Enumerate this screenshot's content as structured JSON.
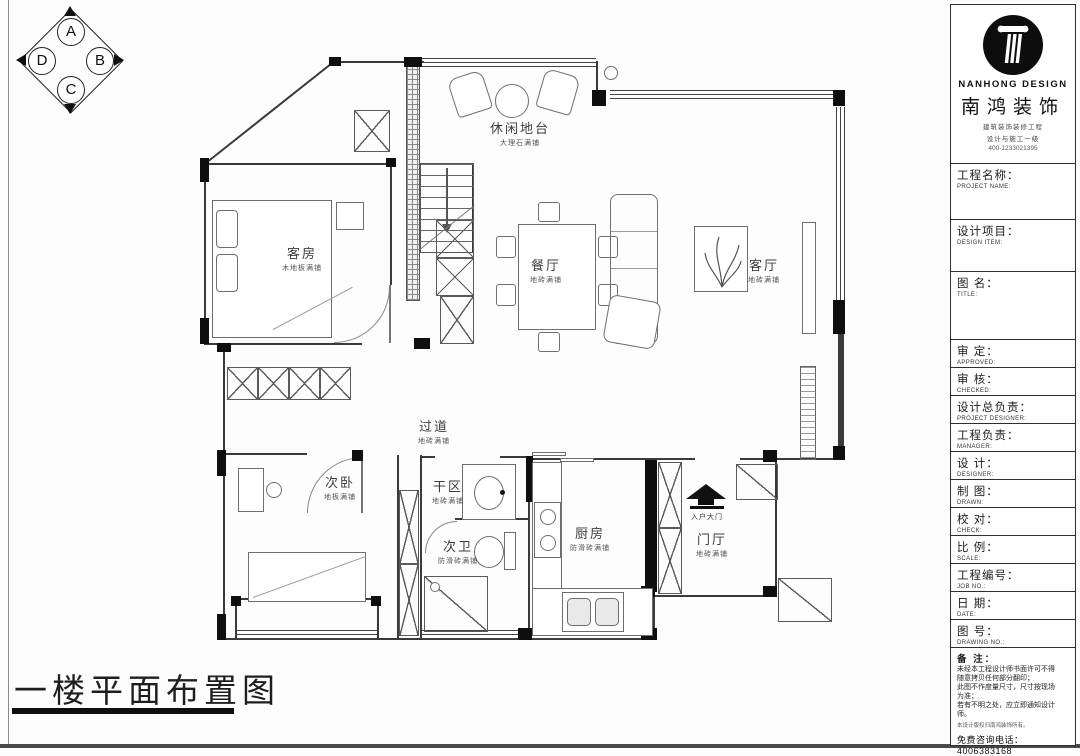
{
  "sheet": {
    "title": "一楼平面布置图",
    "accent_black": "#0d0d0d",
    "line_color": "#3a3a3a"
  },
  "compass": {
    "top": "A",
    "right": "B",
    "bottom": "C",
    "left": "D"
  },
  "plan": {
    "rooms": [
      {
        "name": "客房",
        "finish": "木地板满铺"
      },
      {
        "name": "休闲地台",
        "finish": "大理石满铺"
      },
      {
        "name": "餐厅",
        "finish": "地砖满铺"
      },
      {
        "name": "客厅",
        "finish": "地砖满铺"
      },
      {
        "name": "过道",
        "finish": "地砖满铺"
      },
      {
        "name": "次卧",
        "finish": "地板满铺"
      },
      {
        "name": "干区",
        "finish": "地砖满铺"
      },
      {
        "name": "次卫",
        "finish": "防滑砖满铺"
      },
      {
        "name": "厨房",
        "finish": "防滑砖满铺"
      },
      {
        "name": "门厅",
        "finish": "地砖满铺"
      }
    ],
    "entry_label": "入户大门"
  },
  "title_block": {
    "logo": {
      "en": "NANHONG DESIGN",
      "cn": "南鸿装饰",
      "sub1": "建筑装饰装修工程",
      "sub2": "设计与施工一级",
      "phone": "400-1233021395",
      "icon": "column-icon"
    },
    "fields": [
      {
        "cn": "工程名称：",
        "en": "PROJECT NAME:"
      },
      {
        "cn": "设计项目：",
        "en": "DESIGN ITEM:"
      },
      {
        "cn": "图  名：",
        "en": "TITLE:"
      },
      {
        "cn": "审  定：",
        "en": "APPROVED:"
      },
      {
        "cn": "审  核：",
        "en": "CHECKED:"
      },
      {
        "cn": "设计总负责：",
        "en": "PROJECT DESIGNER:"
      },
      {
        "cn": "工程负责：",
        "en": "MANAGER:"
      },
      {
        "cn": "设  计：",
        "en": "DESIGNER:"
      },
      {
        "cn": "制  图：",
        "en": "DRAWN:"
      },
      {
        "cn": "校  对：",
        "en": "CHECK:"
      },
      {
        "cn": "比  例：",
        "en": "SCALE:"
      },
      {
        "cn": "工程编号：",
        "en": "JOB NO.:"
      },
      {
        "cn": "日  期：",
        "en": "DATE:"
      },
      {
        "cn": "图  号：",
        "en": "DRAWING NO.:"
      }
    ],
    "notes": {
      "label": "备 注：",
      "lines": [
        "未经本工程设计师书面许可不得",
        "随意拷贝任何部分翻印；",
        "此图不作度量尺寸，尺寸按现场",
        "为准；",
        "若有不明之处，应立即通知设计",
        "师。",
        "本设计版权归南鸿装饰所有。"
      ],
      "hotline": "免费咨询电话：4006383168"
    }
  }
}
